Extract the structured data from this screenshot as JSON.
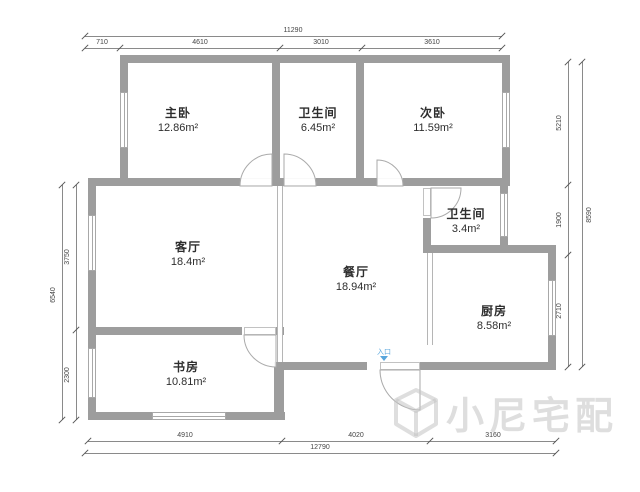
{
  "title": "户型图",
  "rooms": [
    {
      "id": "master-bedroom",
      "name": "主卧",
      "area": "12.86m²"
    },
    {
      "id": "bathroom-1",
      "name": "卫生间",
      "area": "6.45m²"
    },
    {
      "id": "second-bedroom",
      "name": "次卧",
      "area": "11.59m²"
    },
    {
      "id": "living-room",
      "name": "客厅",
      "area": "18.4m²"
    },
    {
      "id": "dining-room",
      "name": "餐厅",
      "area": "18.94m²"
    },
    {
      "id": "bathroom-2",
      "name": "卫生间",
      "area": "3.4m²"
    },
    {
      "id": "kitchen",
      "name": "厨房",
      "area": "8.58m²"
    },
    {
      "id": "study",
      "name": "书房",
      "area": "10.81m²"
    }
  ],
  "entrance": {
    "label": "入口"
  },
  "dimensions": {
    "top": {
      "total": "11290",
      "segments": [
        "710",
        "4610",
        "3010",
        "3610"
      ]
    },
    "bottom": {
      "total": "12790",
      "segments": [
        "4910",
        "4020",
        "3160"
      ]
    },
    "left": {
      "total": "6540",
      "segments": [
        "3750",
        "2300"
      ]
    },
    "right": {
      "total": "8590",
      "segments": [
        "5210",
        "1900",
        "2710"
      ]
    }
  },
  "watermark": {
    "text": "小尼宅配"
  },
  "colors": {
    "wall": "#9d9d9d",
    "dim_line": "#8a8a8a",
    "dim_text": "#444444",
    "room_text": "#2e2e2e",
    "entrance_blue": "#58a6dd",
    "watermark_gray": "#c3c3c3"
  }
}
